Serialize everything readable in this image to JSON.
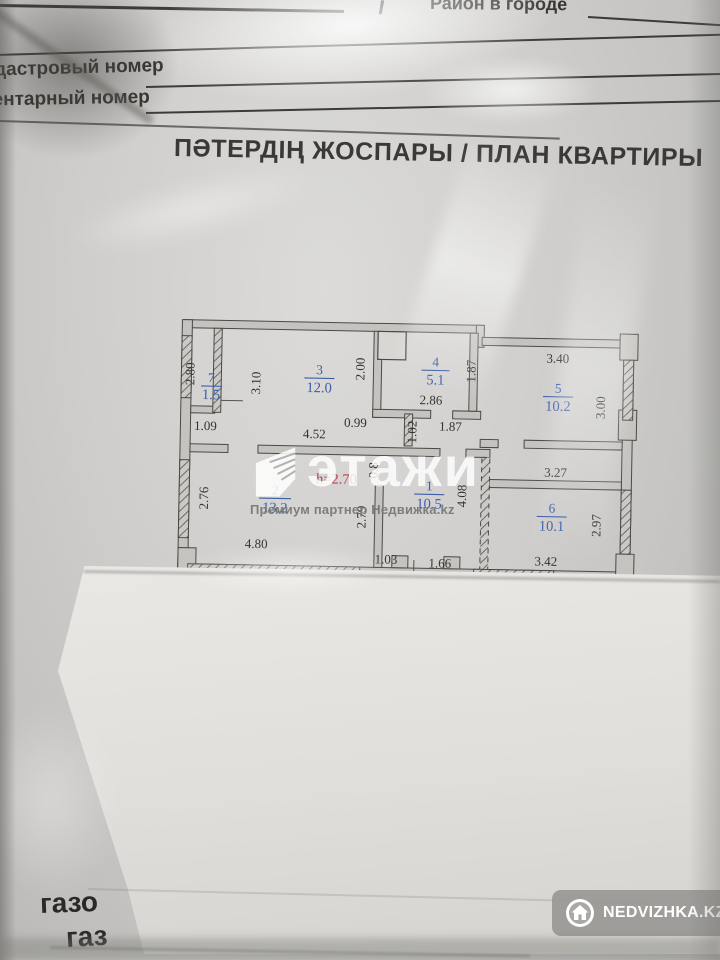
{
  "form": {
    "district_label": "Район в городе",
    "cadastral_label": "кадастровый номер",
    "inventory_label": "инвентарный номер",
    "title": "ПӘТЕРДІҢ ЖОСПАРЫ / ПЛАН КВАРТИРЫ",
    "gas_line1": "газо",
    "gas_line2": "газ"
  },
  "plan": {
    "ceiling_height": "h=2.70",
    "rooms": [
      {
        "number": "7",
        "area": "1.5"
      },
      {
        "number": "3",
        "area": "12.0"
      },
      {
        "number": "4",
        "area": "5.1"
      },
      {
        "number": "5",
        "area": "10.2"
      },
      {
        "number": "2",
        "area": "13.2"
      },
      {
        "number": "1",
        "area": "10.5"
      },
      {
        "number": "6",
        "area": "10.1"
      }
    ],
    "dimensions": {
      "room7_height": "2.80",
      "room7_width": "1.09",
      "room3_left": "3.10",
      "room3_right": "2.00",
      "hall_width": "4.52",
      "opening_099": "0.99",
      "room4_width": "2.86",
      "room4_height": "1.87",
      "wall_102": "1.02",
      "hall_187": "1.87",
      "room5_top": "3.40",
      "room5_right": "3.00",
      "room2_left": "2.76",
      "room2_width": "4.80",
      "room2_right": "2.79",
      "door_08": "0.8",
      "corridor_height": "4.08",
      "bottom_103": "1.03",
      "bottom_166": "1.66",
      "room6_hall_top": "3.27",
      "room6_right": "2.97",
      "room6_width": "3.42"
    }
  },
  "watermark": {
    "brand": "этажи",
    "subtitle": "Премиум партнер Недвижка.kz"
  },
  "badge": {
    "label": "NEDVIZHKA.KZ"
  },
  "colors": {
    "room_label": "#3c5fa7",
    "height_red": "#b5444d",
    "plan_ink": "#44433f",
    "badge_bg": "#9b9a98"
  }
}
